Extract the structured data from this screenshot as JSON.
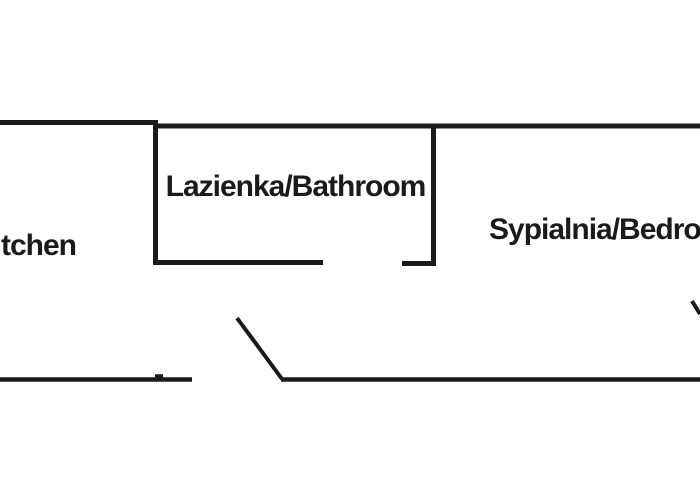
{
  "canvas": {
    "background": "#ffffff",
    "ink": "#1a1a1a"
  },
  "rooms": {
    "bathroom": {
      "label": "Lazienka/Bathroom"
    },
    "bedroom": {
      "label": "Sypialnia/Bedro"
    },
    "kitchen": {
      "label": "tchen"
    }
  }
}
